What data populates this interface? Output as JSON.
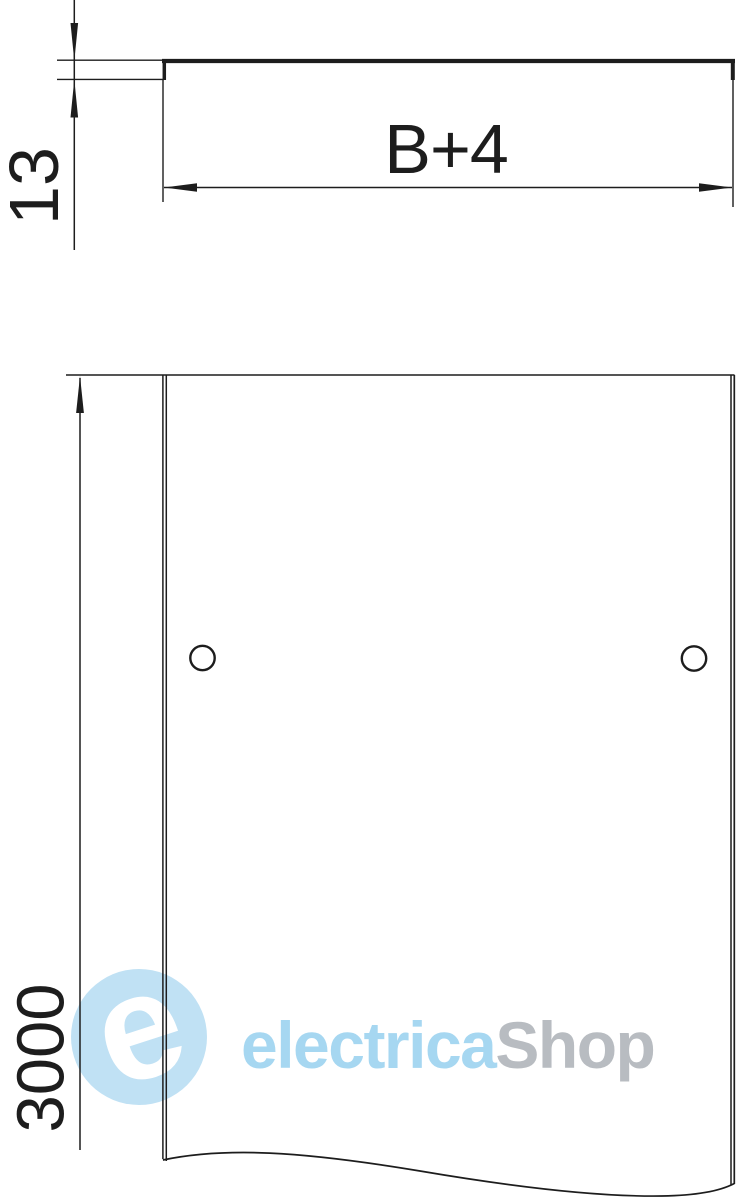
{
  "drawing": {
    "type": "technical-drawing",
    "views": {
      "profile": {
        "height_dimension": "13",
        "width_dimension": "B+4"
      },
      "plan": {
        "length_dimension": "3000",
        "hole_count": 2
      }
    }
  },
  "watermark": {
    "logo_letter": "e",
    "brand_primary": "electrica",
    "brand_secondary": "Shop"
  },
  "colors": {
    "line": "#1d1d1d",
    "background": "#ffffff",
    "watermark_blue": "#a6d7f1",
    "watermark_circle_blue": "#c0e1f4",
    "watermark_gray": "#b8bcc1",
    "watermark_letter_white": "#ffffff"
  }
}
